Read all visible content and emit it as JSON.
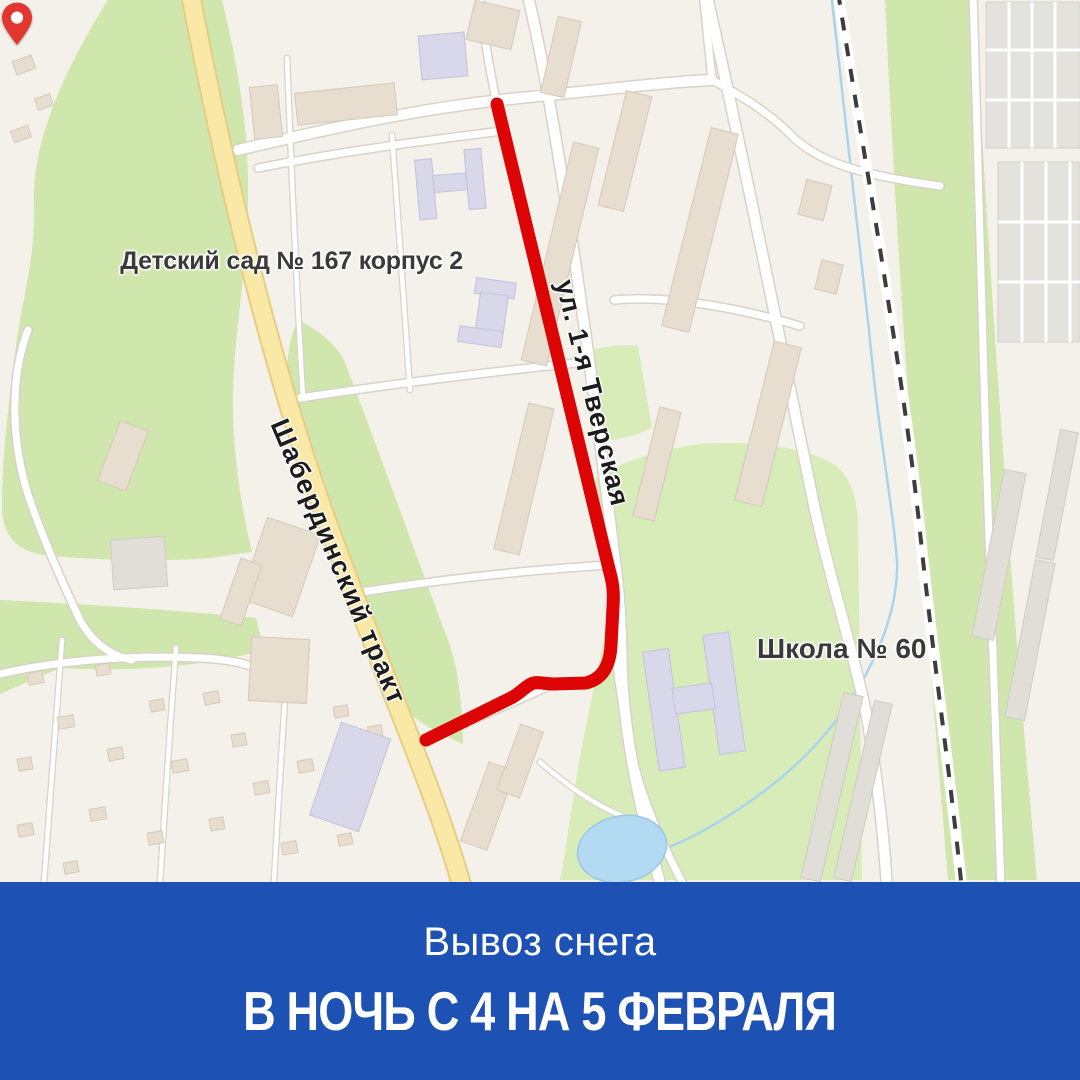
{
  "map": {
    "labels": {
      "kindergarten": "Детский сад № 167 корпус 2",
      "school": "Школа № 60",
      "street_main": "Шабердинский тракт",
      "street_route": "ул. 1-я Тверская"
    },
    "colors": {
      "route": "#dc0404",
      "pin": "#e2362f",
      "water": "#b3daf3",
      "road_yellow": "#fae9a6"
    }
  },
  "banner": {
    "line1": "Вывоз снега",
    "line2": "В НОЧЬ С 4 НА 5 ФЕВРАЛЯ",
    "background": "#1d51b4",
    "text_color": "#ffffff"
  }
}
